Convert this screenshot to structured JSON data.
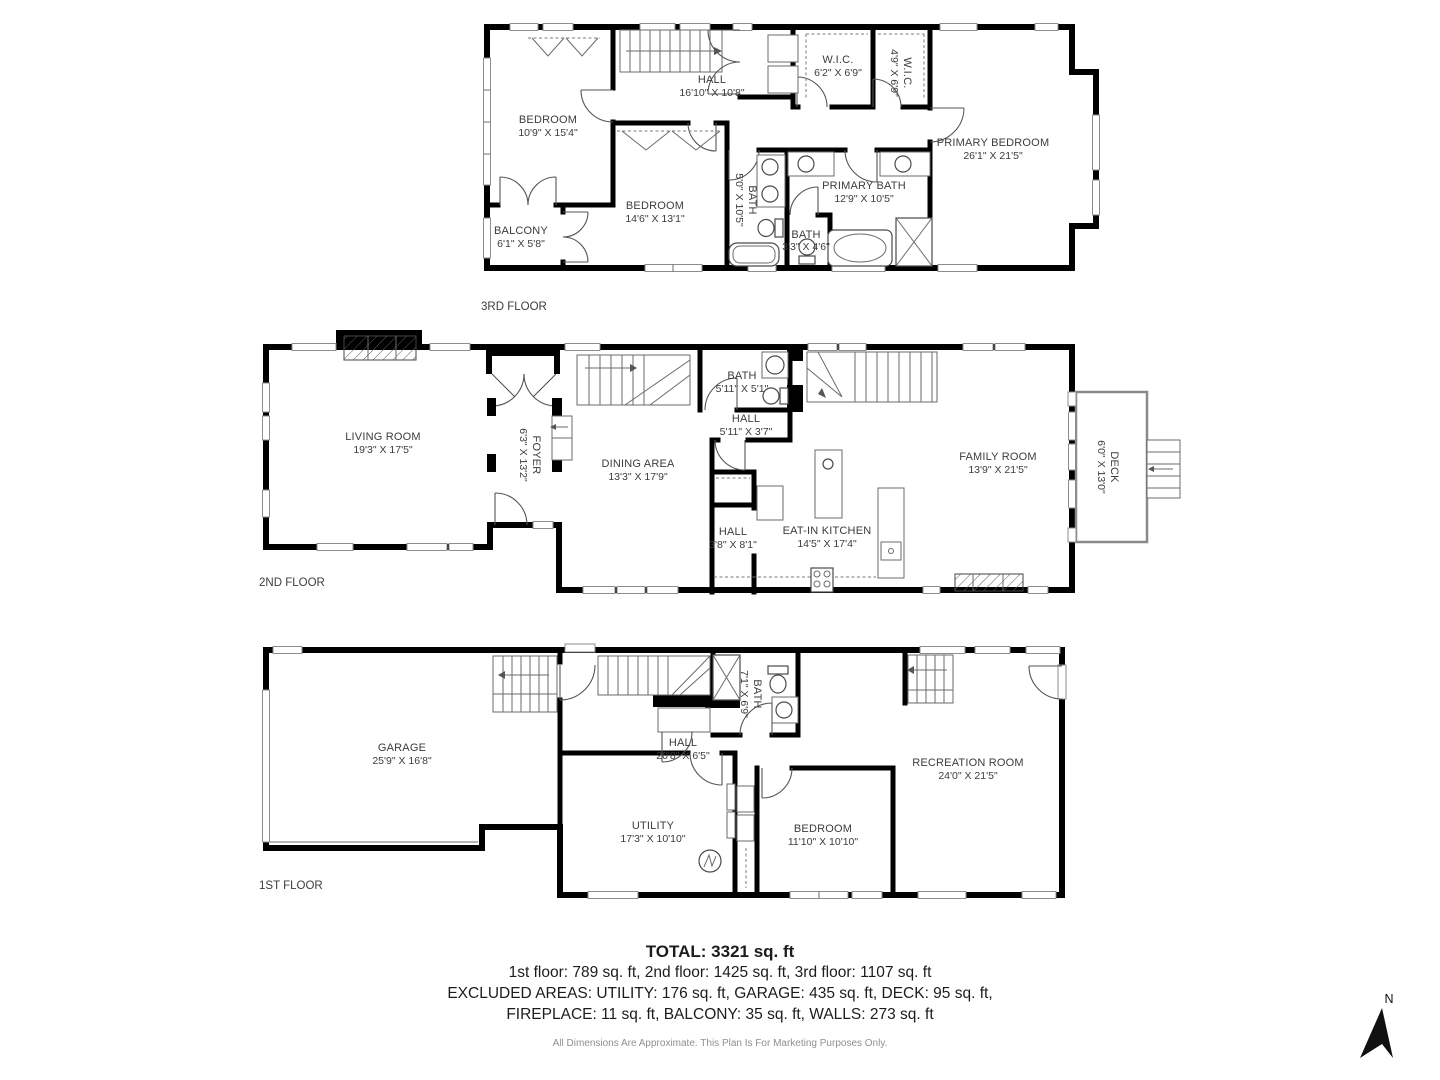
{
  "meta": {
    "background": "#ffffff",
    "wall_color": "#000000",
    "text_color": "#3c3c3c",
    "muted_color": "#8f8f8f"
  },
  "floors": [
    {
      "label": "3RD FLOOR",
      "rooms": [
        {
          "name": "BEDROOM",
          "dims": "10'9\" X 15'4\""
        },
        {
          "name": "HALL",
          "dims": "16'10\" X 10'8\""
        },
        {
          "name": "W.I.C.",
          "dims": "6'2\" X 6'9\""
        },
        {
          "name": "W.I.C.",
          "dims": "4'9\" X 6'9\""
        },
        {
          "name": "PRIMARY BEDROOM",
          "dims": "26'1\" X 21'5\""
        },
        {
          "name": "BEDROOM",
          "dims": "14'6\" X 13'1\""
        },
        {
          "name": "BATH",
          "dims": "5'0\" X 10'5\""
        },
        {
          "name": "PRIMARY BATH",
          "dims": "12'9\" X 10'5\""
        },
        {
          "name": "BATH",
          "dims": "3'3\" X 4'6\""
        },
        {
          "name": "BALCONY",
          "dims": "6'1\" X 5'8\""
        }
      ]
    },
    {
      "label": "2ND FLOOR",
      "rooms": [
        {
          "name": "LIVING ROOM",
          "dims": "19'3\" X 17'5\""
        },
        {
          "name": "FOYER",
          "dims": "6'3\" X 13'2\""
        },
        {
          "name": "DINING AREA",
          "dims": "13'3\" X 17'9\""
        },
        {
          "name": "BATH",
          "dims": "5'11\" X 5'1\""
        },
        {
          "name": "HALL",
          "dims": "5'11\" X 3'7\""
        },
        {
          "name": "HALL",
          "dims": "3'8\" X 8'1\""
        },
        {
          "name": "EAT-IN KITCHEN",
          "dims": "14'5\" X 17'4\""
        },
        {
          "name": "FAMILY ROOM",
          "dims": "13'9\" X 21'5\""
        },
        {
          "name": "DECK",
          "dims": "6'0\" X 13'0\""
        }
      ]
    },
    {
      "label": "1ST FLOOR",
      "rooms": [
        {
          "name": "GARAGE",
          "dims": "25'9\" X 16'8\""
        },
        {
          "name": "HALL",
          "dims": "20'8\" X 6'5\""
        },
        {
          "name": "BATH",
          "dims": "7'1\" X 6'9\""
        },
        {
          "name": "UTILITY",
          "dims": "17'3\" X 10'10\""
        },
        {
          "name": "BEDROOM",
          "dims": "11'10\" X 10'10\""
        },
        {
          "name": "RECREATION ROOM",
          "dims": "24'0\" X 21'5\""
        }
      ]
    }
  ],
  "summary": {
    "total": "TOTAL: 3321 sq. ft",
    "floors_line": "1st floor: 789 sq. ft, 2nd floor: 1425 sq. ft, 3rd floor: 1107 sq. ft",
    "excluded_line_1": "EXCLUDED AREAS: UTILITY: 176 sq. ft, GARAGE: 435 sq. ft, DECK: 95 sq. ft,",
    "excluded_line_2": "FIREPLACE: 11 sq. ft, BALCONY: 35 sq. ft, WALLS: 273 sq. ft",
    "disclaimer": "All Dimensions Are Approximate. This Plan Is For Marketing Purposes Only."
  },
  "compass": {
    "label": "N"
  }
}
